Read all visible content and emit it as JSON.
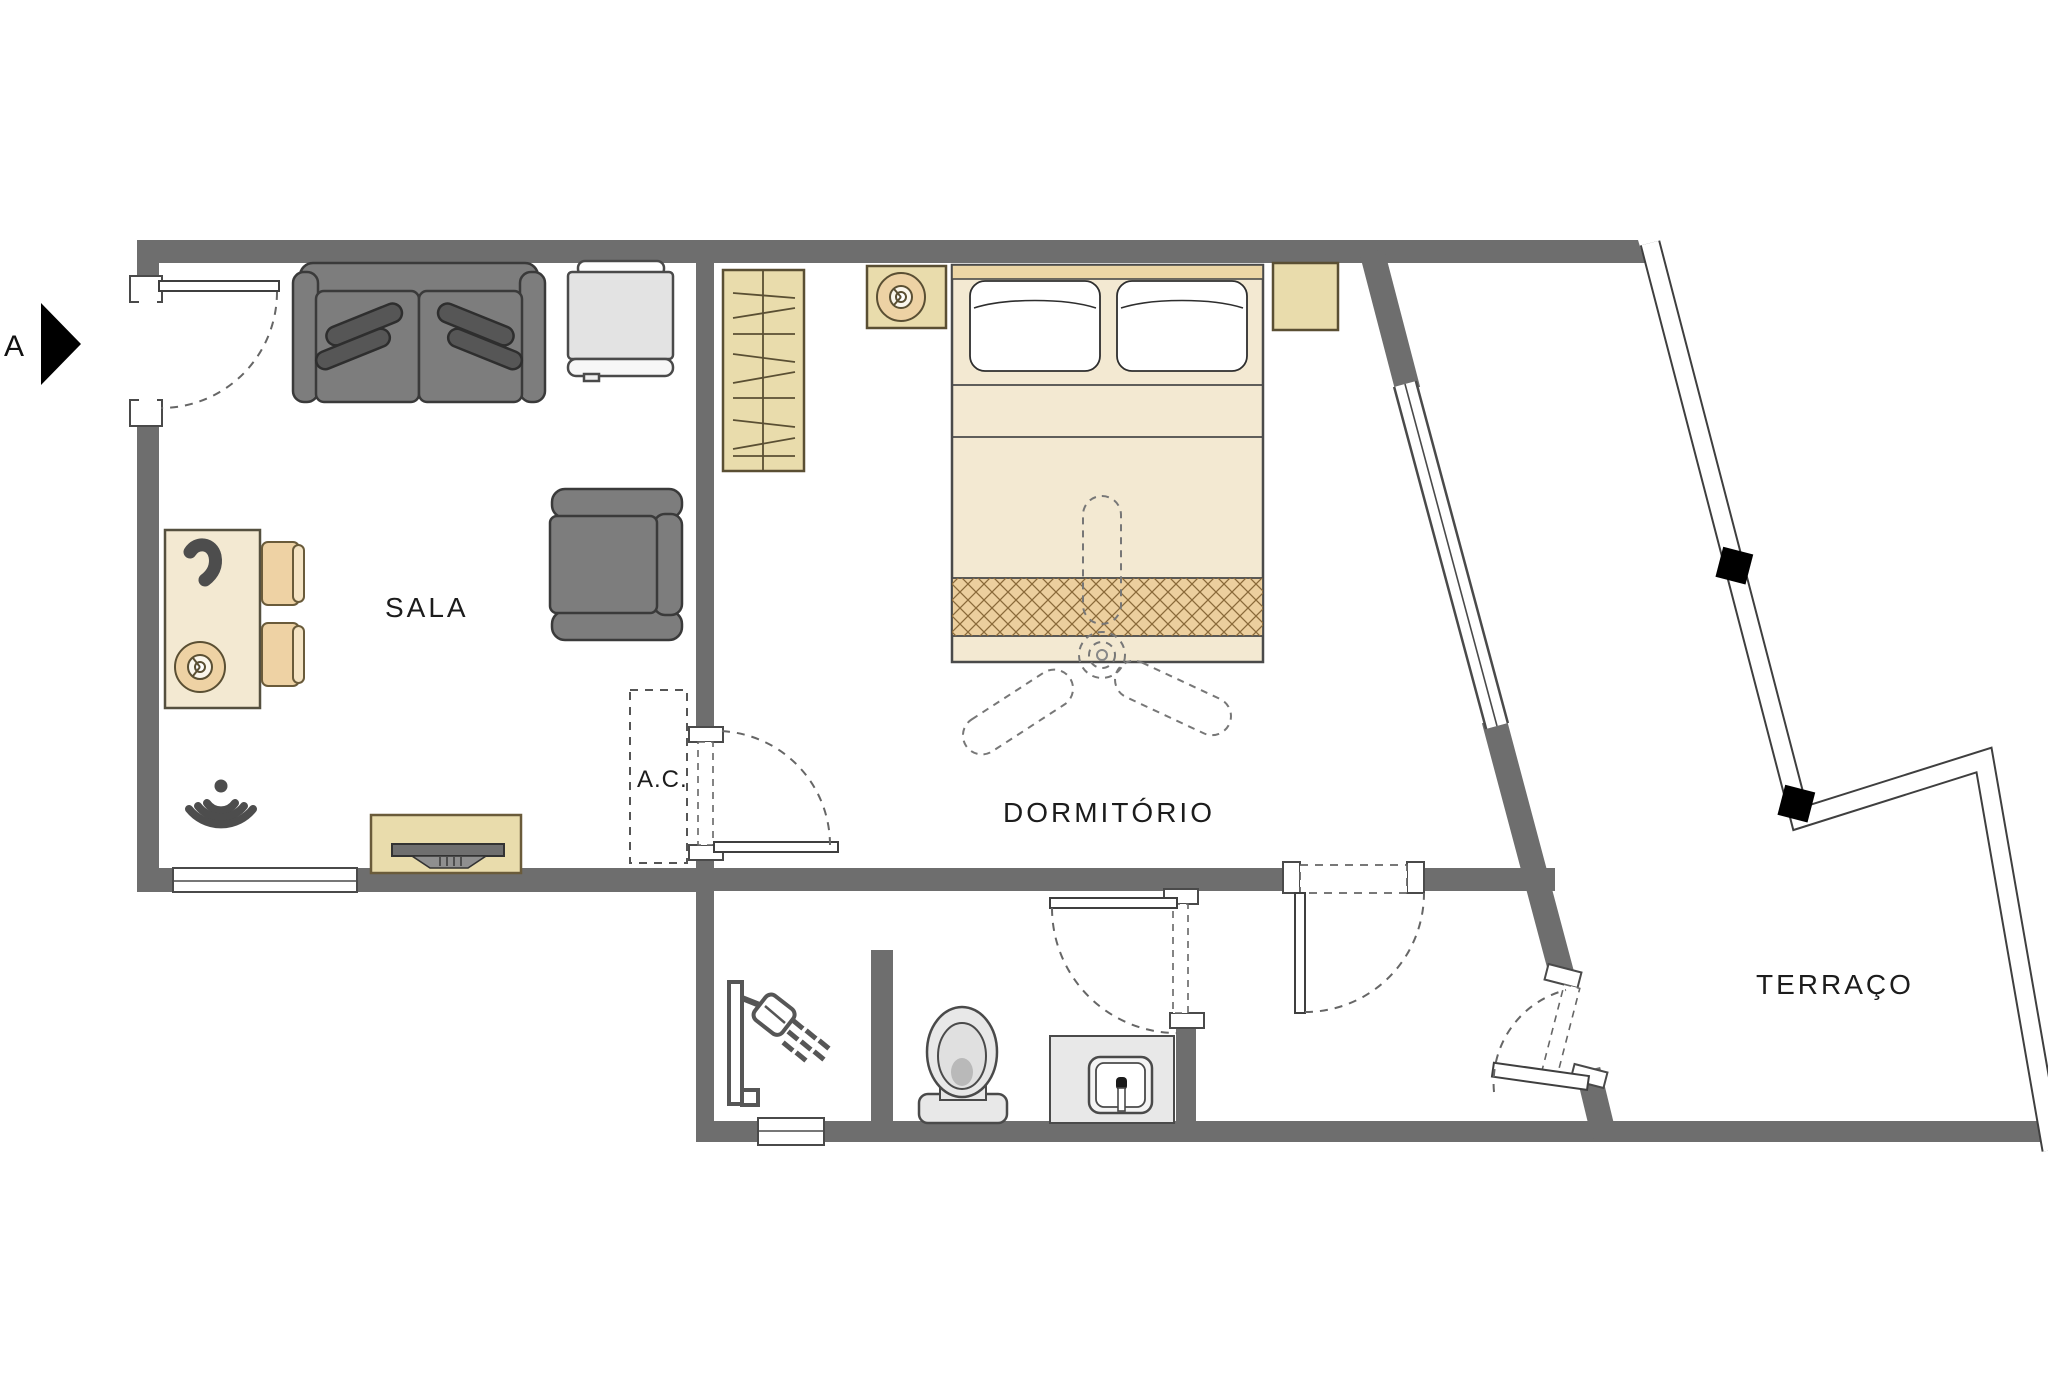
{
  "document": {
    "type": "apartment-floor-plan",
    "language": "pt-BR"
  },
  "labels": {
    "section_marker": "A",
    "living_room": "SALA",
    "ac_unit": "A.C.",
    "bedroom": "DORMITÓRIO",
    "terrace": "TERRAÇO"
  },
  "rooms": [
    {
      "id": "sala",
      "label": "SALA",
      "furniture": [
        "two-seat-sofa-with-cushions",
        "appliance-cabinet",
        "armchair",
        "desk-with-phone-and-lamp",
        "chair",
        "chair",
        "wifi-signal-symbol",
        "tv-sideboard"
      ]
    },
    {
      "id": "dormitorio",
      "label": "DORMITÓRIO",
      "furniture": [
        "wardrobe-with-hangers",
        "nightstand-with-lamp",
        "double-bed-two-pillows",
        "nightstand",
        "ceiling-fan-dashed",
        "ac-unit-dashed-outline"
      ]
    },
    {
      "id": "bathroom",
      "label": "",
      "furniture": [
        "shower-head",
        "toilet",
        "washbasin-counter"
      ]
    },
    {
      "id": "terraco",
      "label": "TERRAÇO",
      "furniture": []
    }
  ],
  "openings": {
    "doors": [
      "entrance-door",
      "sala-dormitorio-door",
      "bathroom-door",
      "dormitorio-hall-door",
      "terrace-door"
    ],
    "windows": [
      "sala-south-window",
      "bathroom-south-window",
      "bedroom-diagonal-window"
    ]
  },
  "colors": {
    "wall": "#6e6e6e",
    "outline": "#3f3f3f",
    "beige_light": "#f3e9d2",
    "beige_mid": "#e9dcac",
    "beige_deep": "#eccf9e",
    "hatch_line": "#8a6a3a",
    "sofa_gray": "#7d7d7d",
    "cushion_gray": "#565656",
    "fixture_gray": "#e8e8e8",
    "icon_gray": "#4d4d4d",
    "dash_gray": "#666666",
    "black": "#000000"
  }
}
